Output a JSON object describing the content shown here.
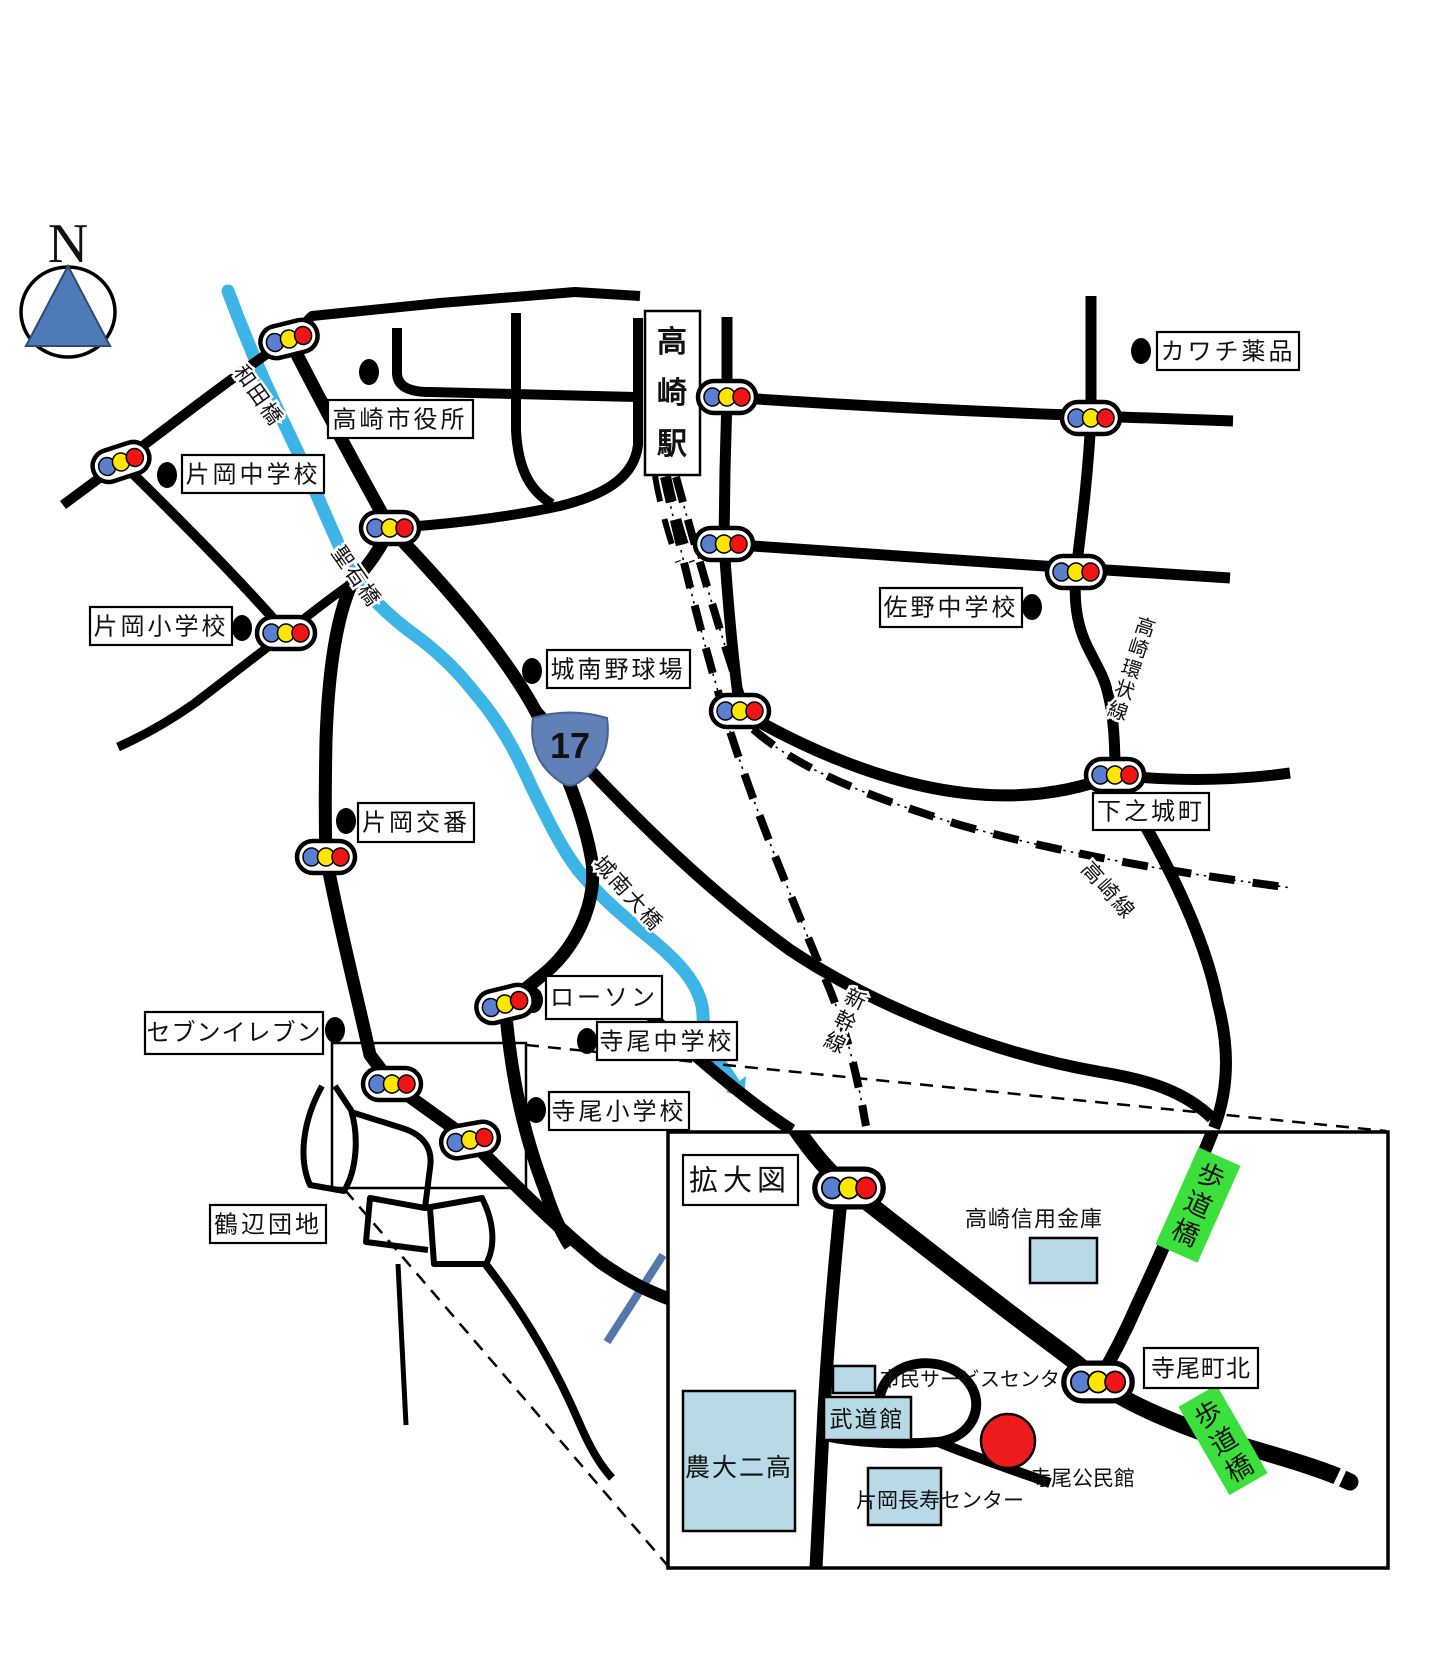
{
  "compass": {
    "label": "N"
  },
  "station": {
    "name": "高崎駅",
    "chars": [
      "高",
      "崎",
      "駅"
    ]
  },
  "route17": {
    "number": "17"
  },
  "places": {
    "kawachi": "カワチ薬品",
    "shiyakusho": "高崎市役所",
    "kataoka_chu": "片岡中学校",
    "kataoka_sho": "片岡小学校",
    "sano_chu": "佐野中学校",
    "jonan_stadium": "城南野球場",
    "shimonojo": "下之城町",
    "kataoka_koban": "片岡交番",
    "lawson": "ローソン",
    "seven_eleven": "セブンイレブン",
    "terao_chu": "寺尾中学校",
    "terao_sho": "寺尾小学校",
    "tsurube_danchi": "鶴辺団地"
  },
  "road_names": {
    "wada_bashi": "和田橋",
    "hijiriishi_bashi": "聖石橋",
    "jonan_ohashi": "城南大橋",
    "kanjo_sen": "高崎環状線",
    "kanjo_chars": [
      "高",
      "崎",
      "環",
      "状",
      "線"
    ],
    "takasaki_sen": "高崎線",
    "shinkansen": "新幹線",
    "shinkansen_chars": [
      "新",
      "幹",
      "線"
    ]
  },
  "inset": {
    "title": "拡大図",
    "shinkin_bank": "高崎信用金庫",
    "service_center": "市民サービスセンター",
    "budokan": "武道館",
    "nodai_niko": "農大二高",
    "choju_center": "片岡長寿センター",
    "kominkan": "寺尾公民館",
    "teraomachi_kita": "寺尾町北",
    "hodokyo": "歩道橋",
    "hodokyo_chars": [
      "歩",
      "道",
      "橋"
    ]
  },
  "colors": {
    "road": "#000000",
    "river": "#3cb4e6",
    "river_dark": "#5578aa",
    "signal_blue": "#5b7fd0",
    "signal_yellow": "#ffe600",
    "signal_red": "#f01414",
    "building_fill": "#b8d9e6",
    "green_label": "#3ce03c",
    "target_red": "#ee1c1c",
    "shield_blue": "#6080b8",
    "compass_blue": "#4f7ab8"
  }
}
